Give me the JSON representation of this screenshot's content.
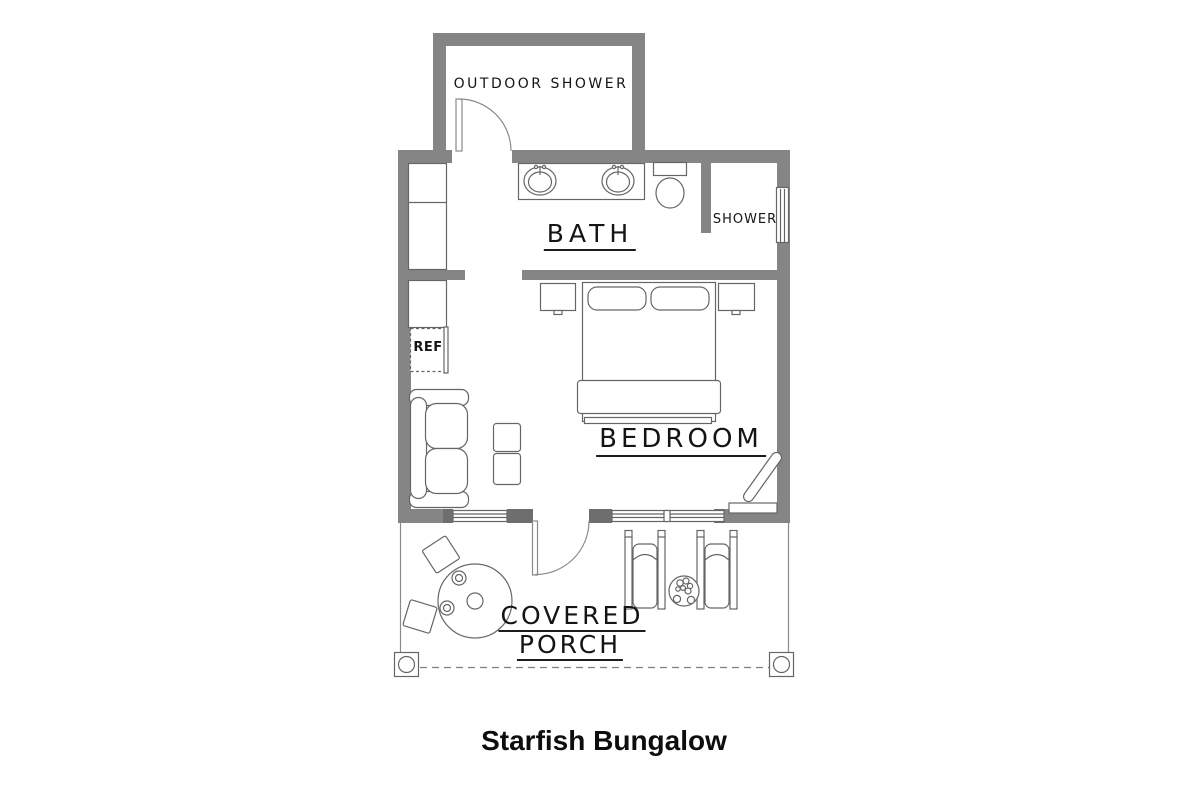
{
  "title": "Starfish Bungalow",
  "labels": {
    "outdoor_shower": "OUTDOOR SHOWER",
    "bath": "BATH",
    "shower": "SHOWER",
    "ref": "REF",
    "bedroom": "BEDROOM",
    "porch_word1": "COVERED",
    "porch_word2": "PORCH"
  },
  "colors": {
    "wall": "#858585",
    "wall_dark": "#6e6e6e",
    "line": "#666666",
    "text": "#141414",
    "background": "#ffffff"
  }
}
